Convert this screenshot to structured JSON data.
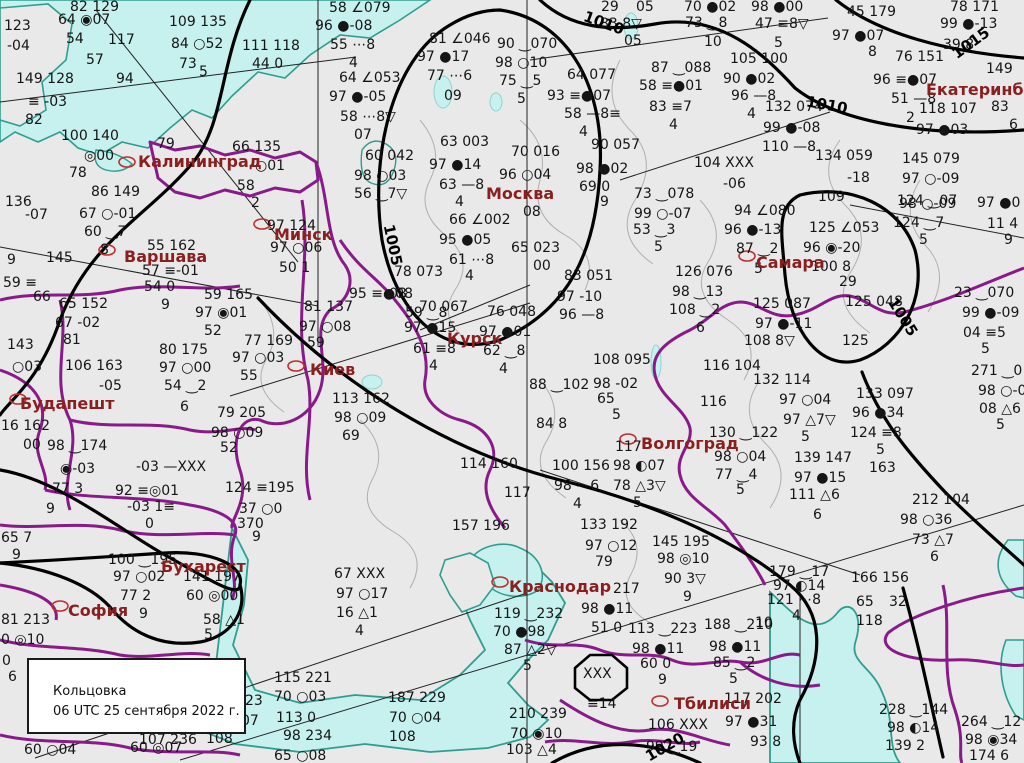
{
  "info_box": {
    "line1": "Кольцовка",
    "line2": "06 UTC 25 сентября 2022 г."
  },
  "colors": {
    "land": "#e9e9e9",
    "water": "#c6f1ef",
    "coast": "#2f9d8f",
    "national_border": "#8a1a8a",
    "admin_border": "#b0b0b0",
    "isobar": "#000000",
    "city_text": "#8b1f1f"
  },
  "cities": [
    [
      "Калининград",
      138,
      152
    ],
    [
      "Варшава",
      124,
      247
    ],
    [
      "Минск",
      274,
      225
    ],
    [
      "Киев",
      310,
      360
    ],
    [
      "Москва",
      486,
      184
    ],
    [
      "Курск",
      447,
      329
    ],
    [
      "Самара",
      756,
      253
    ],
    [
      "Волгоград",
      641,
      434
    ],
    [
      "Будапешт",
      20,
      394
    ],
    [
      "Бухарест",
      161,
      557
    ],
    [
      "София",
      68,
      601
    ],
    [
      "Краснодар",
      509,
      577
    ],
    [
      "Тбилиси",
      674,
      694
    ],
    [
      "Екатеринбург",
      926,
      80
    ]
  ],
  "isobar_labels": [
    [
      "1005",
      372,
      236,
      78
    ],
    [
      "1005",
      882,
      308,
      58
    ],
    [
      "1010",
      806,
      96,
      10
    ],
    [
      "1010",
      583,
      14,
      20
    ],
    [
      "1015",
      950,
      34,
      -36
    ],
    [
      "1020",
      644,
      738,
      -30
    ]
  ],
  "stations": [
    [
      "82 129",
      70,
      0
    ],
    [
      "64 ◉07",
      58,
      13
    ],
    [
      "123",
      4,
      19
    ],
    [
      "-04",
      7,
      39
    ],
    [
      "54",
      66,
      32
    ],
    [
      "109 135",
      169,
      15
    ],
    [
      "84 ○52",
      171,
      37
    ],
    [
      "73",
      179,
      57
    ],
    [
      "5",
      199,
      65
    ],
    [
      "117",
      108,
      33
    ],
    [
      "57",
      86,
      53
    ],
    [
      "94",
      116,
      72
    ],
    [
      "149 128",
      16,
      72
    ],
    [
      "≡ -03",
      28,
      95
    ],
    [
      "82",
      25,
      113
    ],
    [
      "100 140",
      61,
      129
    ],
    [
      "◎00",
      84,
      149
    ],
    [
      "78",
      69,
      166
    ],
    [
      "79",
      157,
      137
    ],
    [
      "66 135",
      232,
      140
    ],
    [
      "○01",
      255,
      159
    ],
    [
      "58",
      237,
      179
    ],
    [
      "2",
      251,
      196
    ],
    [
      "86 149",
      91,
      185
    ],
    [
      "67 ○-01",
      79,
      207
    ],
    [
      "60 ‿7",
      84,
      225
    ],
    [
      "8",
      100,
      243
    ],
    [
      "9",
      7,
      253
    ],
    [
      "145",
      46,
      251
    ],
    [
      "55 162",
      147,
      239
    ],
    [
      "57 ≡-01",
      142,
      264
    ],
    [
      "136",
      5,
      195
    ],
    [
      "-07",
      25,
      208
    ],
    [
      "59 ≡",
      3,
      276
    ],
    [
      "58 ∠079",
      329,
      1
    ],
    [
      "96 ●-08",
      315,
      19
    ],
    [
      "55 ⋯8",
      330,
      38
    ],
    [
      "4",
      349,
      56
    ],
    [
      "64 ∠053",
      339,
      71
    ],
    [
      "97 ●-05",
      329,
      90
    ],
    [
      "58 ⋯8▽",
      340,
      110
    ],
    [
      "07",
      354,
      128
    ],
    [
      "111 118",
      242,
      39
    ],
    [
      "44 0",
      252,
      57
    ],
    [
      "81 ∠046",
      429,
      32
    ],
    [
      "97 ●17",
      417,
      50
    ],
    [
      "77 ⋯6",
      427,
      69
    ],
    [
      "09",
      444,
      89
    ],
    [
      "90 ‿070",
      497,
      37
    ],
    [
      "98 ○10",
      495,
      56
    ],
    [
      "75 ‿5",
      499,
      74
    ],
    [
      "5",
      517,
      92
    ],
    [
      "64 077",
      567,
      68
    ],
    [
      "93 ≡●07",
      547,
      89
    ],
    [
      "58 —8≡",
      564,
      107
    ],
    [
      "4",
      579,
      125
    ],
    [
      "29",
      601,
      0
    ],
    [
      "05",
      636,
      0
    ],
    [
      "83 8▽",
      600,
      17
    ],
    [
      "05",
      624,
      34
    ],
    [
      "70 ●02",
      684,
      0
    ],
    [
      "73 ‿8",
      685,
      16
    ],
    [
      "10",
      704,
      35
    ],
    [
      "98 ●00",
      751,
      0
    ],
    [
      "47 ≡8▽",
      755,
      17
    ],
    [
      "5",
      774,
      36
    ],
    [
      "105 100",
      730,
      52
    ],
    [
      "87 ‿088",
      651,
      61
    ],
    [
      "58 ≡●01",
      639,
      79
    ],
    [
      "83 ≡7",
      649,
      100
    ],
    [
      "4",
      669,
      118
    ],
    [
      "90 ●02",
      723,
      72
    ],
    [
      "96 —8",
      731,
      89
    ],
    [
      "4",
      747,
      107
    ],
    [
      "132 074",
      765,
      100
    ],
    [
      "99 ●-08",
      763,
      121
    ],
    [
      "110 —8",
      762,
      140
    ],
    [
      "104 XXX",
      694,
      156
    ],
    [
      "-06",
      723,
      177
    ],
    [
      "45 179",
      847,
      5
    ],
    [
      "78 171",
      950,
      0
    ],
    [
      "97 ●07",
      832,
      29
    ],
    [
      "99 ●-13",
      940,
      17
    ],
    [
      "39 8",
      943,
      38
    ],
    [
      "8",
      868,
      45
    ],
    [
      "76 151",
      895,
      50
    ],
    [
      "149",
      986,
      62
    ],
    [
      "96 ≡●07",
      873,
      73
    ],
    [
      "51 —8",
      891,
      92
    ],
    [
      "118 107",
      919,
      102
    ],
    [
      "2",
      906,
      111
    ],
    [
      "83",
      991,
      100
    ],
    [
      "6",
      1009,
      118
    ],
    [
      "97 ●03",
      916,
      123
    ],
    [
      "134 059",
      815,
      149
    ],
    [
      "-18",
      847,
      171
    ],
    [
      "145 079",
      902,
      152
    ],
    [
      "97 ○-09",
      902,
      172
    ],
    [
      "124 ‿07",
      897,
      194
    ],
    [
      "11 4",
      987,
      217
    ],
    [
      "9",
      1004,
      233
    ],
    [
      "60 042",
      365,
      149
    ],
    [
      "98 ○03",
      354,
      169
    ],
    [
      "56 ‿7▽",
      354,
      187
    ],
    [
      "63 003",
      440,
      135
    ],
    [
      "70 016",
      511,
      145
    ],
    [
      "90 057",
      591,
      138
    ],
    [
      "97 ●14",
      429,
      158
    ],
    [
      "96 ○04",
      499,
      168
    ],
    [
      "98 ●02",
      576,
      162
    ],
    [
      "63 —8",
      439,
      178
    ],
    [
      "69 0",
      579,
      180
    ],
    [
      "9",
      600,
      195
    ],
    [
      "73 ‿078",
      634,
      187
    ],
    [
      "4",
      455,
      195
    ],
    [
      "08",
      523,
      205
    ],
    [
      "66 ∠002",
      449,
      213
    ],
    [
      "99 ○-07",
      634,
      207
    ],
    [
      "53 ‿3",
      633,
      223
    ],
    [
      "5",
      654,
      240
    ],
    [
      "95 ●05",
      439,
      233
    ],
    [
      "65 023",
      511,
      241
    ],
    [
      "61 ⋯8",
      449,
      253
    ],
    [
      "00",
      533,
      259
    ],
    [
      "4",
      465,
      269
    ],
    [
      "83 051",
      564,
      269
    ],
    [
      "126 076",
      675,
      265
    ],
    [
      "98 ‿13",
      672,
      285
    ],
    [
      "108 ‿2",
      669,
      303
    ],
    [
      "6",
      696,
      321
    ],
    [
      "97 -10",
      557,
      290
    ],
    [
      "96 —8",
      559,
      308
    ],
    [
      "78 073",
      394,
      265
    ],
    [
      "08",
      389,
      287
    ],
    [
      "81 137",
      304,
      300
    ],
    [
      "97 ○08",
      299,
      320
    ],
    [
      "59",
      307,
      336
    ],
    [
      "95 ≡●08",
      349,
      287
    ],
    [
      "59 ‿8",
      405,
      306
    ],
    [
      "70 067",
      419,
      300
    ],
    [
      "97 ●15",
      404,
      321
    ],
    [
      "61 ≡8",
      413,
      342
    ],
    [
      "4",
      429,
      359
    ],
    [
      "76 048",
      487,
      305
    ],
    [
      "97 ●01",
      479,
      325
    ],
    [
      "62 ‿8",
      483,
      344
    ],
    [
      "4",
      499,
      362
    ],
    [
      "77 169",
      244,
      334
    ],
    [
      "97 ○03",
      232,
      351
    ],
    [
      "55",
      240,
      369
    ],
    [
      "113 162",
      332,
      392
    ],
    [
      "98 ○09",
      334,
      411
    ],
    [
      "69",
      342,
      429
    ],
    [
      "88 ‿102",
      529,
      378
    ],
    [
      "98 -02",
      593,
      377
    ],
    [
      "108 095",
      593,
      353
    ],
    [
      "84 8",
      536,
      417
    ],
    [
      "65",
      597,
      392
    ],
    [
      "5",
      612,
      408
    ],
    [
      "116 104",
      703,
      359
    ],
    [
      "132 114",
      753,
      373
    ],
    [
      "97 ○04",
      779,
      393
    ],
    [
      "130 ‿122",
      709,
      426
    ],
    [
      "114 160",
      460,
      457
    ],
    [
      "100 156",
      552,
      459
    ],
    [
      "98 ◐07",
      613,
      459
    ],
    [
      "98 —6",
      554,
      479
    ],
    [
      "4",
      573,
      497
    ],
    [
      "157 196",
      452,
      519
    ],
    [
      "117",
      504,
      486
    ],
    [
      "66",
      33,
      290
    ],
    [
      "65 152",
      59,
      297
    ],
    [
      "67 -02",
      55,
      316
    ],
    [
      "81",
      63,
      333
    ],
    [
      "143",
      7,
      338
    ],
    [
      "○03",
      12,
      360
    ],
    [
      "106 163",
      65,
      359
    ],
    [
      "-05",
      99,
      379
    ],
    [
      "16 162",
      1,
      419
    ],
    [
      "00",
      23,
      438
    ],
    [
      "98 ‿174",
      47,
      439
    ],
    [
      "54 0",
      144,
      280
    ],
    [
      "9",
      161,
      298
    ],
    [
      "59 165",
      204,
      288
    ],
    [
      "97 ◉01",
      195,
      306
    ],
    [
      "52",
      204,
      324
    ],
    [
      "80 175",
      159,
      343
    ],
    [
      "97 ○00",
      159,
      361
    ],
    [
      "54 ‿2",
      164,
      379
    ],
    [
      "6",
      180,
      400
    ],
    [
      "79 205",
      217,
      406
    ],
    [
      "98 ○09",
      211,
      426
    ],
    [
      "52",
      220,
      441
    ],
    [
      "◉-03",
      60,
      462
    ],
    [
      "-03 —XXX",
      136,
      460
    ],
    [
      "77 3",
      52,
      482
    ],
    [
      "92 ≡◎01",
      115,
      484
    ],
    [
      "-03 1≡",
      127,
      500
    ],
    [
      "0",
      145,
      517
    ],
    [
      "9",
      46,
      502
    ],
    [
      "124 ≡195",
      225,
      481
    ],
    [
      "37 ○0",
      239,
      502
    ],
    [
      "100 ‿195",
      108,
      553
    ],
    [
      "97 ○02",
      113,
      570
    ],
    [
      "77 2",
      120,
      589
    ],
    [
      "141 197",
      183,
      570
    ],
    [
      "60 ◎00",
      186,
      589
    ],
    [
      "9",
      139,
      607
    ],
    [
      "58 △1",
      203,
      613
    ],
    [
      "5",
      204,
      628
    ],
    [
      "65 7",
      1,
      531
    ],
    [
      "9",
      12,
      548
    ],
    [
      "370",
      237,
      517
    ],
    [
      "9",
      252,
      530
    ],
    [
      "81 213",
      1,
      613
    ],
    [
      "0 ◎10",
      1,
      633
    ],
    [
      "0",
      2,
      654
    ],
    [
      "6",
      8,
      670
    ],
    [
      "60 ○04",
      24,
      743
    ],
    [
      "60 ◎07",
      130,
      741
    ],
    [
      "97 124",
      267,
      219
    ],
    [
      "97 ○06",
      270,
      241
    ],
    [
      "50 1",
      279,
      261
    ],
    [
      "109",
      818,
      190
    ],
    [
      "94 ∠080",
      734,
      204
    ],
    [
      "96 ●-13",
      724,
      223
    ],
    [
      "87 ‿2",
      736,
      242
    ],
    [
      "5",
      754,
      262
    ],
    [
      "125 ∠053",
      809,
      221
    ],
    [
      "96 ◉-20",
      803,
      241
    ],
    [
      "100 8",
      811,
      260
    ],
    [
      "29",
      839,
      275
    ],
    [
      "98 ○-09",
      899,
      197
    ],
    [
      "124 ‿7",
      893,
      216
    ],
    [
      "5",
      919,
      233
    ],
    [
      "97 ●0",
      977,
      196
    ],
    [
      "125 087",
      753,
      297
    ],
    [
      "97 ●-11",
      755,
      317
    ],
    [
      "108 8▽",
      744,
      334
    ],
    [
      "125 048",
      845,
      295
    ],
    [
      "125",
      842,
      334
    ],
    [
      "23 ‿070",
      954,
      286
    ],
    [
      "99 ●-09",
      962,
      306
    ],
    [
      "04 ≡5",
      963,
      326
    ],
    [
      "5",
      981,
      342
    ],
    [
      "271 ‿0",
      971,
      364
    ],
    [
      "98 ○-0",
      978,
      384
    ],
    [
      "08 △6",
      979,
      402
    ],
    [
      "5",
      996,
      418
    ],
    [
      "116",
      700,
      395
    ],
    [
      "97 △7▽",
      783,
      413
    ],
    [
      "5",
      801,
      430
    ],
    [
      "117",
      615,
      440
    ],
    [
      "98 ○04",
      714,
      450
    ],
    [
      "77 ‿4",
      715,
      468
    ],
    [
      "78 △3▽",
      613,
      479
    ],
    [
      "5",
      633,
      496
    ],
    [
      "5",
      736,
      483
    ],
    [
      "139 147",
      794,
      451
    ],
    [
      "97 ●15",
      794,
      471
    ],
    [
      "111 △6",
      789,
      488
    ],
    [
      "6",
      813,
      508
    ],
    [
      "133 097",
      856,
      387
    ],
    [
      "96 ●34",
      852,
      406
    ],
    [
      "124 ≡8",
      850,
      426
    ],
    [
      "5",
      876,
      443
    ],
    [
      "163",
      869,
      461
    ],
    [
      "212 104",
      912,
      493
    ],
    [
      "98 ○36",
      900,
      513
    ],
    [
      "73 △7",
      912,
      533
    ],
    [
      "6",
      930,
      550
    ],
    [
      "133 192",
      580,
      518
    ],
    [
      "97 ○12",
      585,
      539
    ],
    [
      "145 195",
      652,
      535
    ],
    [
      "67 XXX",
      334,
      567
    ],
    [
      "97 ○17",
      336,
      587
    ],
    [
      "16 △1",
      336,
      606
    ],
    [
      "4",
      355,
      624
    ],
    [
      "115 221",
      274,
      671
    ],
    [
      "70 ○03",
      274,
      690
    ],
    [
      "113 0",
      276,
      711
    ],
    [
      "98 234",
      283,
      729
    ],
    [
      "65 ○08",
      274,
      749
    ],
    [
      "187 229",
      388,
      691
    ],
    [
      "70 ○04",
      389,
      711
    ],
    [
      "108",
      389,
      730
    ],
    [
      "79",
      595,
      555
    ],
    [
      "98 ◎10",
      657,
      552
    ],
    [
      "90 3▽",
      664,
      572
    ],
    [
      "9",
      683,
      590
    ],
    [
      "217",
      613,
      582
    ],
    [
      "98 ●11",
      581,
      602
    ],
    [
      "119 ‿232",
      494,
      607
    ],
    [
      "51 0",
      591,
      621
    ],
    [
      "113 ‿223",
      628,
      622
    ],
    [
      "188 ‿210",
      704,
      618
    ],
    [
      "70 ●98",
      493,
      625
    ],
    [
      "87 △2▽",
      504,
      643
    ],
    [
      "5",
      523,
      659
    ],
    [
      "98 ●11",
      632,
      642
    ],
    [
      "60 0",
      640,
      657
    ],
    [
      "9",
      658,
      673
    ],
    [
      "98 ●11",
      709,
      640
    ],
    [
      "85 ‿2",
      713,
      656
    ],
    [
      "5",
      729,
      672
    ],
    [
      "XXX",
      583,
      667
    ],
    [
      "≡14",
      587,
      697
    ],
    [
      "117 202",
      724,
      692
    ],
    [
      "106 XXX",
      648,
      718
    ],
    [
      "97 ●31",
      725,
      715
    ],
    [
      "93 8",
      750,
      735
    ],
    [
      "99 ‿19",
      646,
      740
    ],
    [
      "210 239",
      509,
      707
    ],
    [
      "70 ◉10",
      510,
      727
    ],
    [
      "103 △4",
      506,
      743
    ],
    [
      "23",
      245,
      694
    ],
    [
      "07",
      241,
      714
    ],
    [
      "107 236",
      139,
      733
    ],
    [
      "108",
      206,
      732
    ],
    [
      "179 ‿17",
      769,
      565
    ],
    [
      "97 ◐14",
      773,
      579
    ],
    [
      "121 ⋯8",
      767,
      593
    ],
    [
      "4",
      792,
      609
    ],
    [
      "10",
      755,
      616
    ],
    [
      "166 156",
      851,
      571
    ],
    [
      "65",
      856,
      595
    ],
    [
      "32",
      889,
      595
    ],
    [
      "118",
      856,
      614
    ],
    [
      "228 ‿144",
      879,
      703
    ],
    [
      "98 ◐14",
      887,
      721
    ],
    [
      "139 2",
      885,
      739
    ],
    [
      "264 ‿12",
      961,
      715
    ],
    [
      "98 ◉34",
      965,
      733
    ],
    [
      "174 6",
      969,
      749
    ]
  ]
}
